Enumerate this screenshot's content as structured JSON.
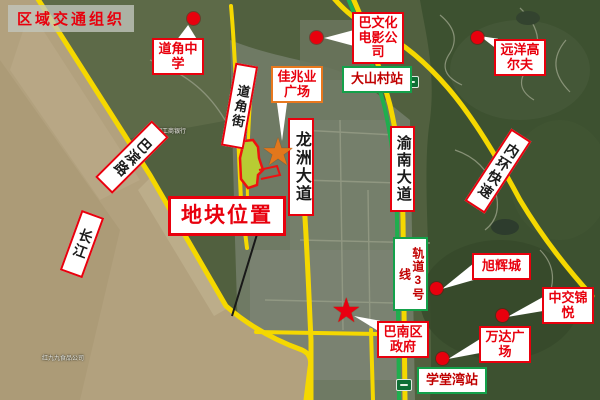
{
  "map_title": "区域交通组织",
  "labels": {
    "daojiao_school": {
      "text": "道角中学"
    },
    "ba_culture_film": {
      "text": "巴文化电影公司"
    },
    "yuanyang_golf": {
      "text": "远洋高尔夫"
    },
    "dashancun_station": {
      "text": "大山村站"
    },
    "jiazhaoye_plaza": {
      "text": "佳兆业广场"
    },
    "daojiao_street": {
      "text": "道角街"
    },
    "longzhou_avenue": {
      "text": "龙洲大道"
    },
    "plot_location": {
      "text": "地块位置"
    },
    "changjiang_river": {
      "text": "长江"
    },
    "babin_road": {
      "text": "巴滨路"
    },
    "yunan_avenue": {
      "text": "渝南大道"
    },
    "neihuan_expressway": {
      "text": "内环快速"
    },
    "rail_line3": {
      "text": "轨道3号线"
    },
    "xuhui_city": {
      "text": "旭辉城"
    },
    "zhongjiao_jinyue": {
      "text": "中交锦悦"
    },
    "wanda_plaza": {
      "text": "万达广场"
    },
    "banan_government": {
      "text": "巴南区政府"
    },
    "xuetangwan_station": {
      "text": "学堂湾站"
    }
  },
  "background_labels": [
    {
      "text": "中国工商银行"
    },
    {
      "text": "红九九食品公司"
    }
  ],
  "colors": {
    "callout_red": "#e8000d",
    "station_green": "#13a14a",
    "plaza_orange": "#e8781e",
    "road_yellow": "#f5d800",
    "rail_green": "#1fae4e",
    "plot_fill": "#b8cc33",
    "river_brown": "#b1a07e",
    "title_red": "#e8000d"
  }
}
